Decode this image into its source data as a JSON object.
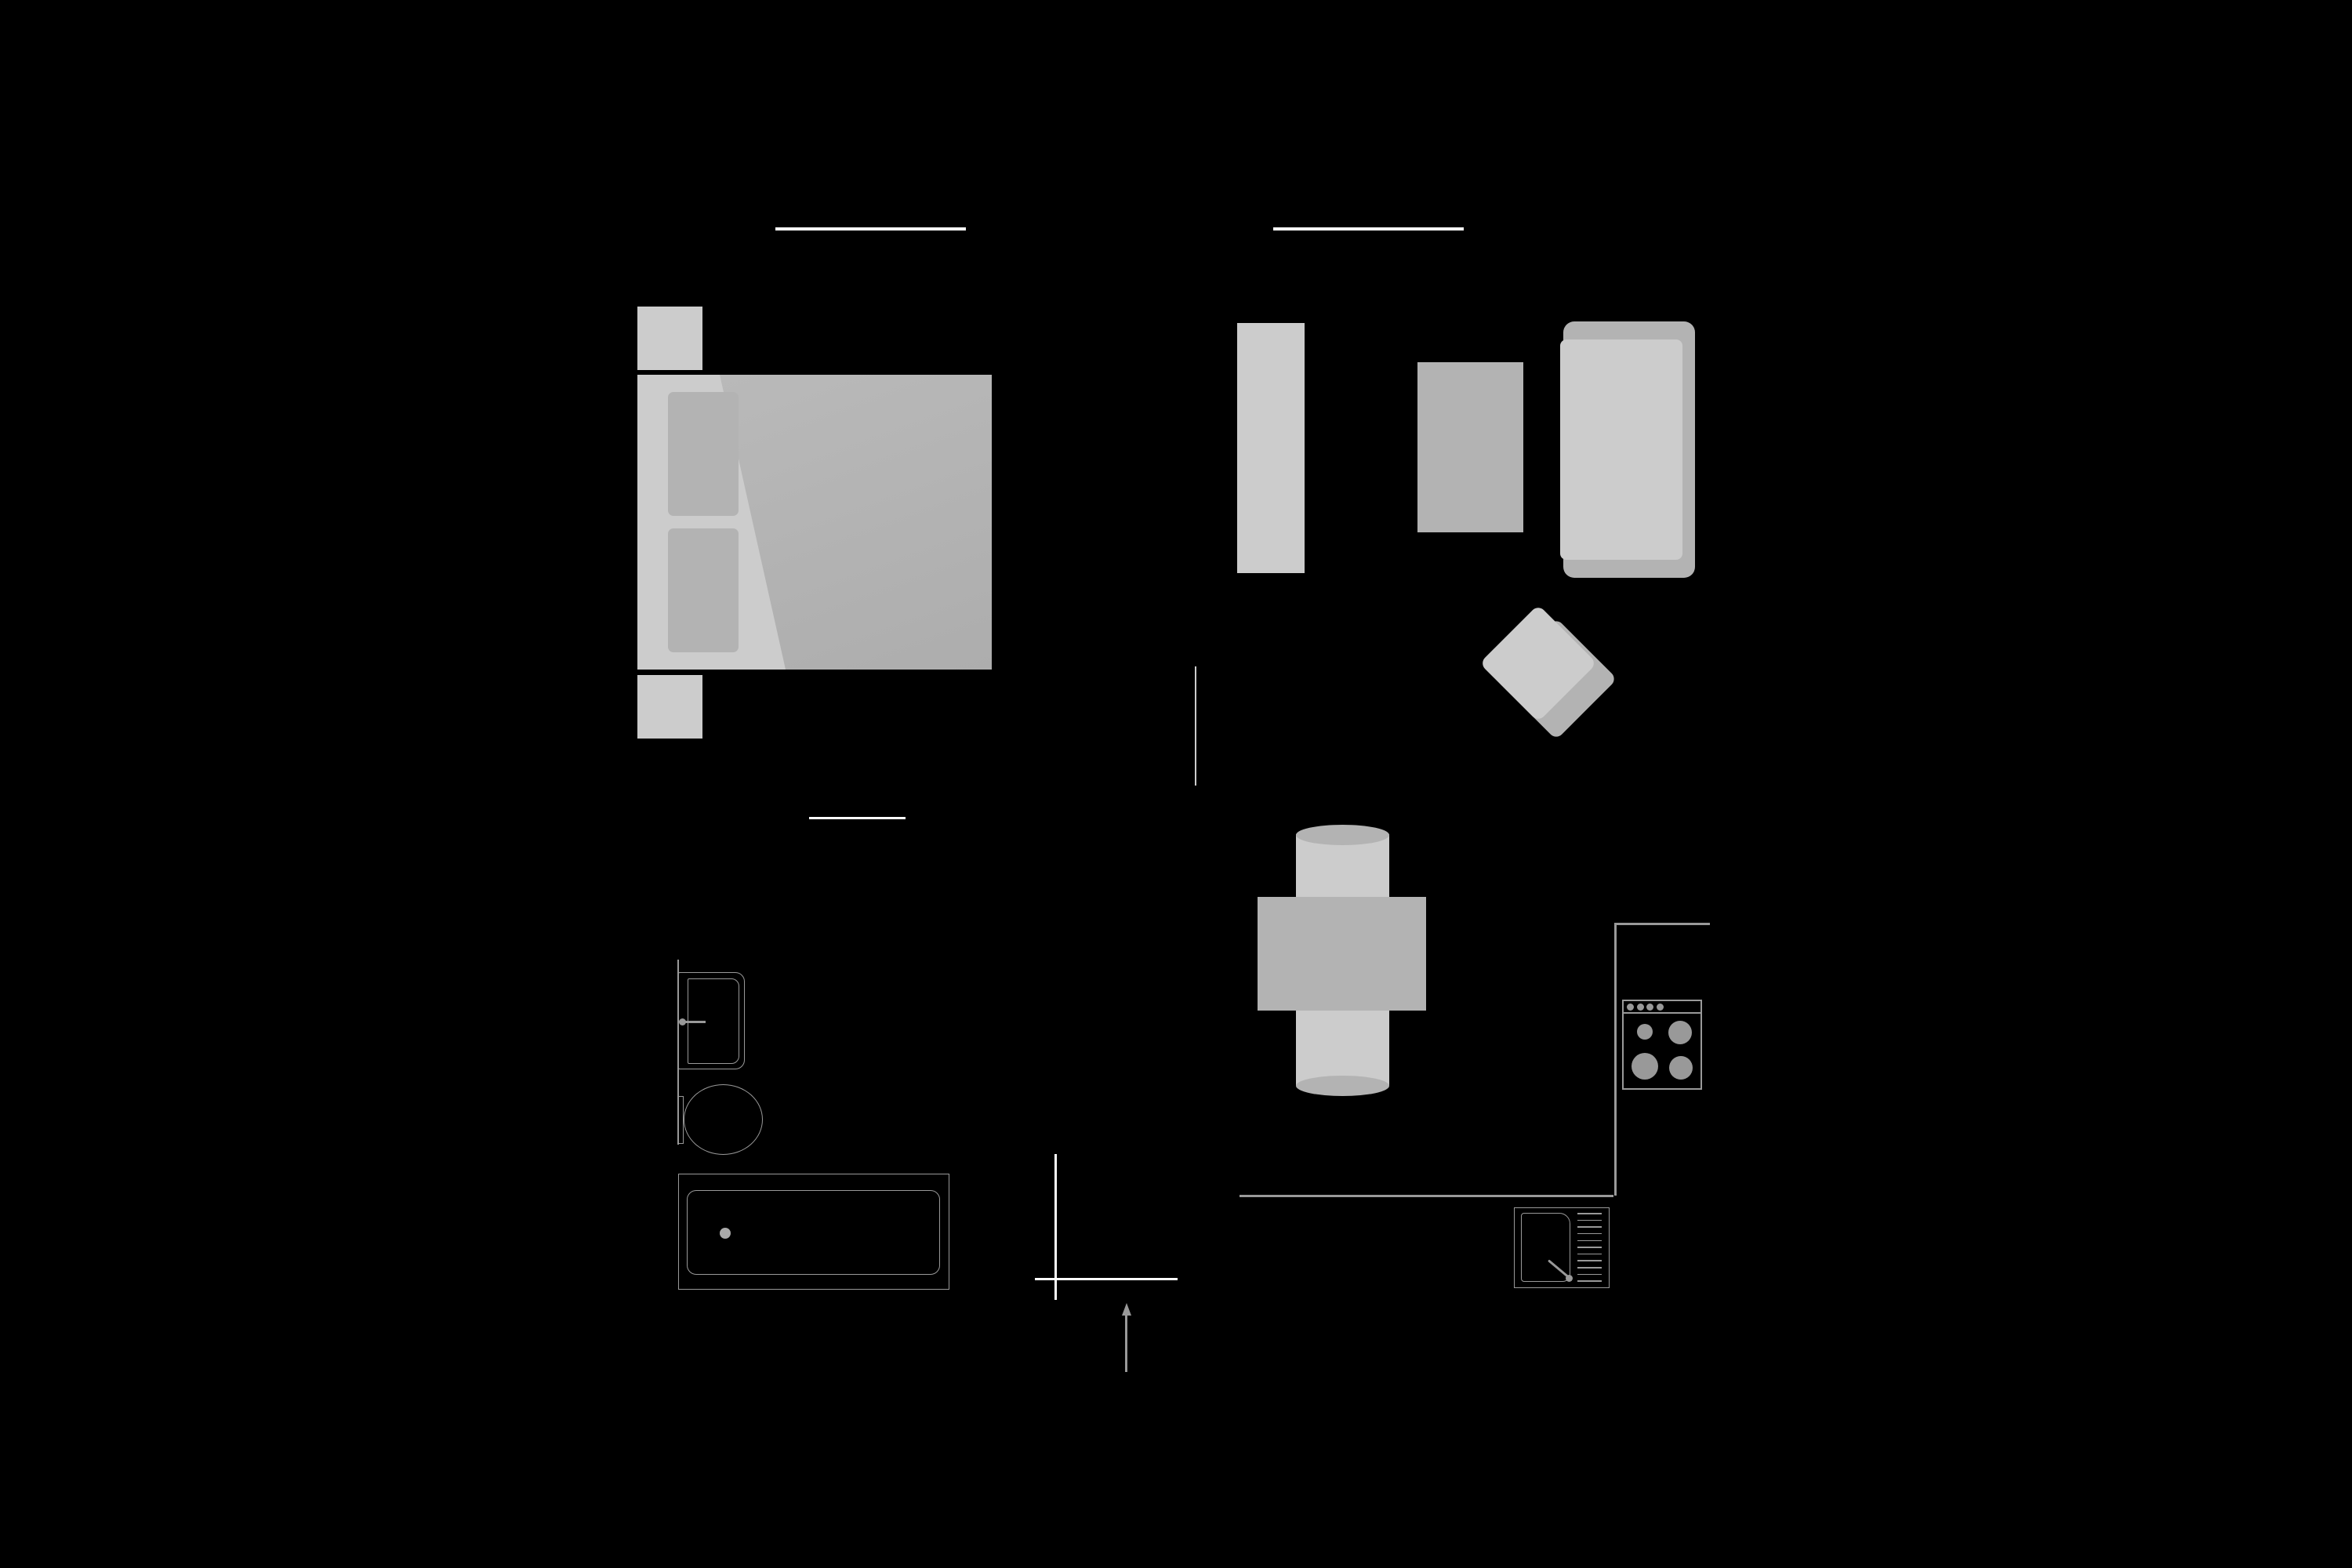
{
  "diagram": {
    "type": "apartment-floor-plan",
    "background": "black",
    "areas": [
      "bedroom",
      "living-room",
      "dining-area",
      "kitchen",
      "bathroom",
      "entrance"
    ],
    "furniture": {
      "bedroom": [
        "double-bed",
        "blanket",
        "pillow",
        "pillow",
        "nightstand",
        "nightstand"
      ],
      "living_room": [
        "sideboard",
        "rug",
        "sofa",
        "armchair"
      ],
      "dining_area": [
        "table",
        "chair",
        "chair"
      ],
      "kitchen": [
        "stove",
        "sink-with-drainboard",
        "counter"
      ],
      "bathroom": [
        "washbasin",
        "toilet",
        "bathtub"
      ]
    }
  },
  "colors": {
    "bg": "#000000",
    "light": "#cccccc",
    "mid": "#b3b3b3",
    "stroke": "#999999",
    "wall": "#ffffff"
  },
  "kitchen": {
    "stove": {
      "knob_count": 4,
      "burner_count": 4
    },
    "sink": {
      "drainboard_line_count": 11
    }
  },
  "entrance": {
    "arrow_direction": "up"
  }
}
